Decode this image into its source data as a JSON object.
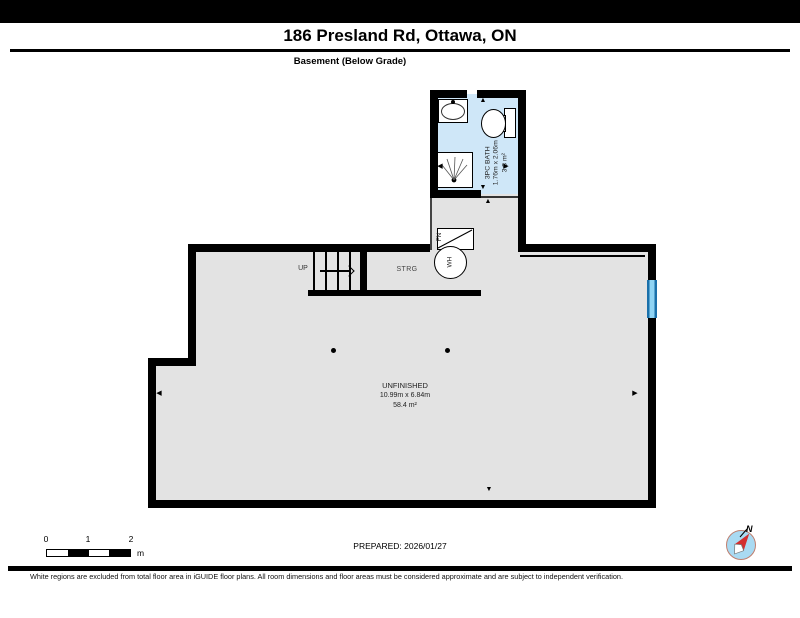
{
  "page": {
    "title": "186 Presland Rd, Ottawa, ON",
    "floor_label": "Basement (Below Grade)",
    "prepared_label": "PREPARED: 2026/01/27",
    "disclaimer": "White regions are excluded from total floor area in iGUIDE floor plans. All room dimensions and floor areas must be considered approximate and are subject to independent verification."
  },
  "rooms": {
    "bath": {
      "name": "3PC BATH",
      "dimensions": "1.76m x 2.06m",
      "area": "3.3 m²"
    },
    "storage": {
      "name": "STRG"
    },
    "unfinished": {
      "name": "UNFINISHED",
      "dimensions": "10.99m x 6.84m",
      "area": "58.4 m²"
    }
  },
  "stairs": {
    "direction_label": "UP"
  },
  "equipment": {
    "furnace_label": "FN",
    "water_heater_label": "WH"
  },
  "scale_bar": {
    "tick_labels": [
      "0",
      "1",
      "2"
    ],
    "unit_label": "m"
  },
  "compass": {
    "north_label": "N"
  },
  "icons": {
    "arrow_up": "▲",
    "arrow_down": "▼",
    "arrow_left": "◀",
    "arrow_right": "▶"
  },
  "colors": {
    "wall_black": "#000000",
    "floor_gray": "#e3e3e3",
    "bath_blue": "#cfe7f8",
    "storage_beige": "#f0e8d9",
    "window_blue": "#1a70aa",
    "compass_fill": "#a9daf2",
    "needle_red": "#d32f2f"
  }
}
